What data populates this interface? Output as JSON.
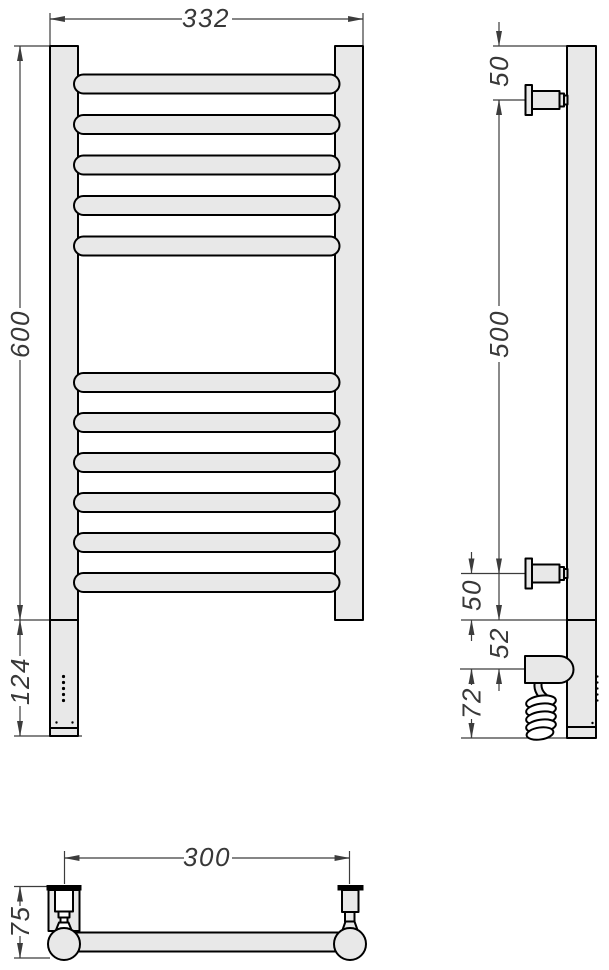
{
  "drawing": {
    "background": "#ffffff",
    "outline_color": "#000000",
    "dimension_color": "#3c3c3c",
    "body_fill_color": "#e8e8e8",
    "front_view": {
      "width_label": "332",
      "height_label": "600",
      "lower_section_label": "124",
      "rail_count_top_group": 5,
      "rail_count_bottom_group": 6,
      "indicator_dot_count": 5
    },
    "side_view": {
      "top_bracket_offset_label": "50",
      "bracket_span_label": "500",
      "bottom_bracket_offset_label": "50",
      "housing_offset_label": "52",
      "cable_drop_label": "72"
    },
    "bottom_view": {
      "bracket_span_label": "300",
      "depth_label": "75"
    }
  }
}
